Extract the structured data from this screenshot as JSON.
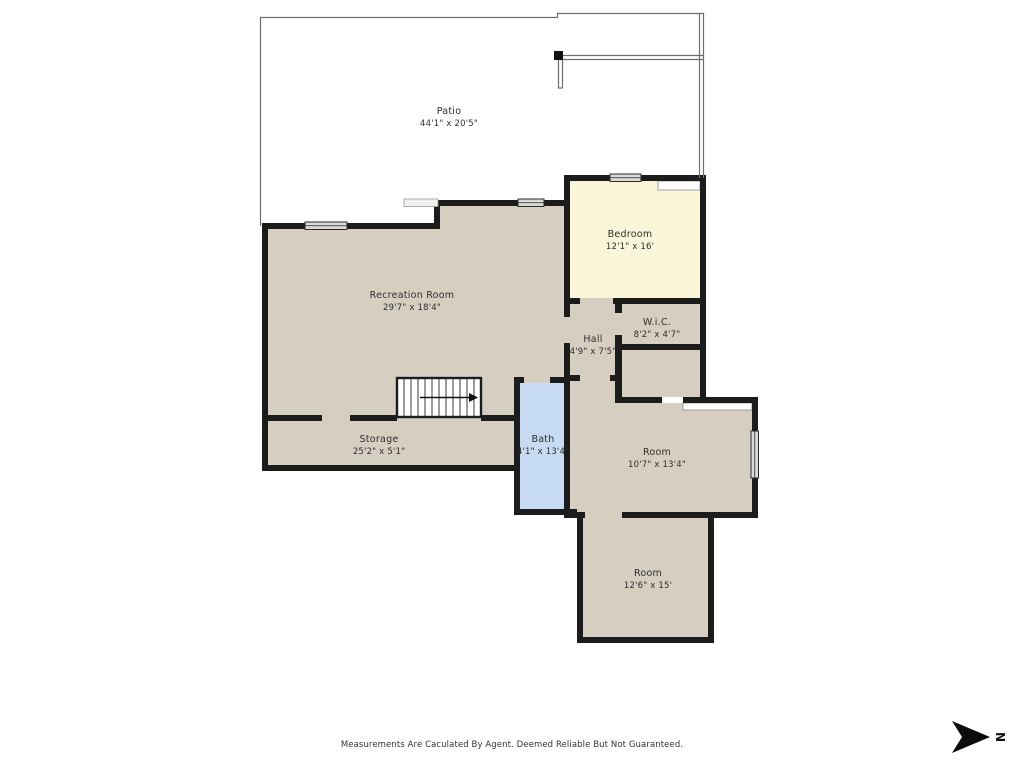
{
  "colors": {
    "background": "#ffffff",
    "wall": "#1c1c1c",
    "room_fill": "#d6cec1",
    "bedroom_fill": "#fbf5d9",
    "bath_fill": "#c6daf1",
    "window_fill": "#d9d9d9",
    "patio_line": "#6e6e6e"
  },
  "rooms": [
    {
      "id": "patio",
      "name": "Patio",
      "dims": "44'1\" x 20'5\""
    },
    {
      "id": "bedroom",
      "name": "Bedroom",
      "dims": "12'1\" x 16'"
    },
    {
      "id": "recreation-room",
      "name": "Recreation Room",
      "dims": "29'7\" x 18'4\""
    },
    {
      "id": "hall",
      "name": "Hall",
      "dims": "4'9\" x 7'5\""
    },
    {
      "id": "wic",
      "name": "W.i.C.",
      "dims": "8'2\" x 4'7\""
    },
    {
      "id": "storage",
      "name": "Storage",
      "dims": "25'2\" x 5'1\""
    },
    {
      "id": "bath",
      "name": "Bath",
      "dims": "4'1\" x 13'4\""
    },
    {
      "id": "room-middle",
      "name": "Room",
      "dims": "10'7\" x 13'4\""
    },
    {
      "id": "room-lower",
      "name": "Room",
      "dims": "12'6\" x 15'"
    }
  ],
  "compass": {
    "label": "N",
    "direction": "right"
  },
  "footer": {
    "text": "Measurements Are Caculated By Agent. Deemed Reliable But Not Guaranteed."
  }
}
